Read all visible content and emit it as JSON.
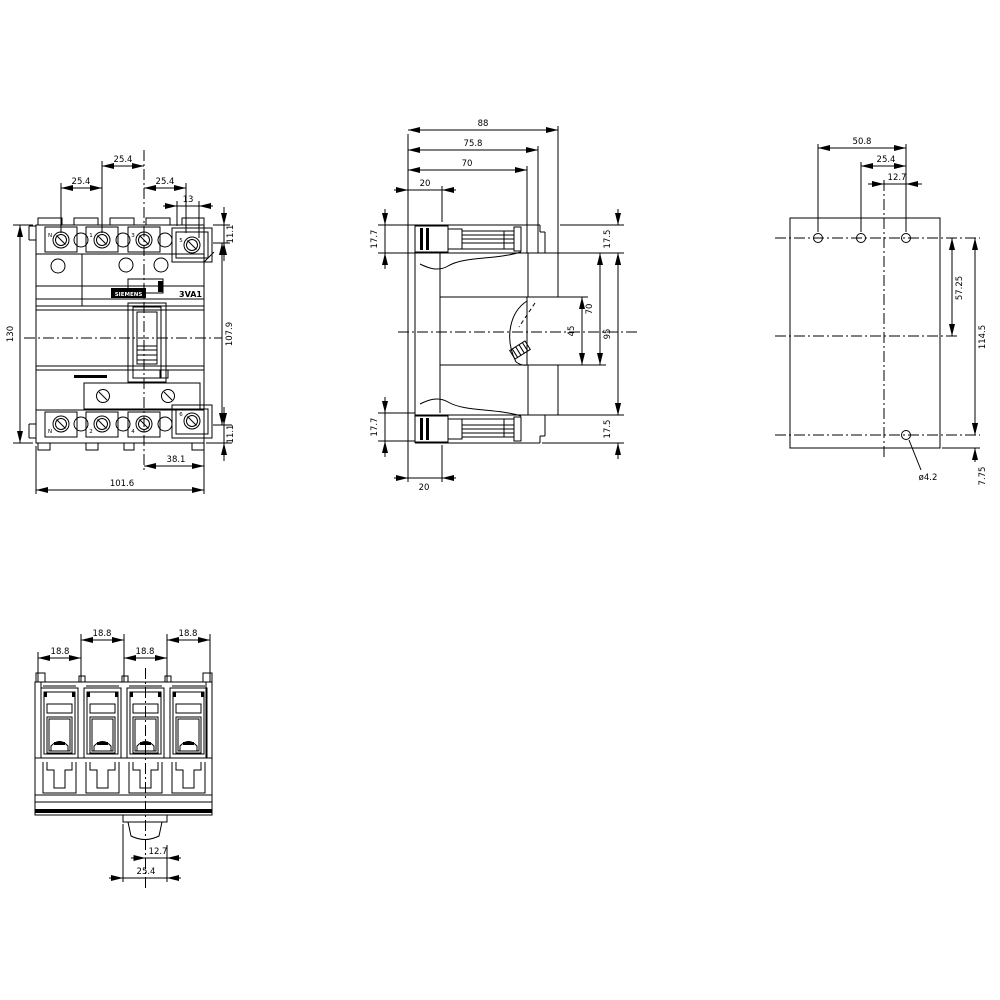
{
  "front": {
    "brand": "SIEMENS",
    "product": "3VA1",
    "poles_top": [
      "N",
      "1",
      "3",
      "5"
    ],
    "poles_bottom": [
      "N",
      "2",
      "4",
      "6"
    ],
    "dims": {
      "pitch_mid": "25.4",
      "pitch_left": "25.4",
      "pitch_right": "25.4",
      "neutral_offset": "13",
      "terminal_top": "11.1",
      "overall_height": "130",
      "case_height": "107.9",
      "terminal_bottom": "11.1",
      "handle_to_edge": "38.1",
      "overall_width": "101.6"
    }
  },
  "side": {
    "dims": {
      "depth": "88",
      "front_face": "75.8",
      "step": "70",
      "lug_top": "20",
      "lug_height_top": "17.7",
      "cover_top": "17.5",
      "window": "45",
      "front_height": "70",
      "case_height": "95",
      "lug_height_bottom": "17.7",
      "cover_bottom": "17.5",
      "lug_bottom": "20"
    }
  },
  "rear": {
    "dims": {
      "hole_span": "50.8",
      "hole_mid": "25.4",
      "hole_to_center": "12.7",
      "upper_height": "57.25",
      "overall_height": "114.5",
      "bottom_offset": "7.75",
      "hole_diameter": "ø4.2"
    }
  },
  "bottom": {
    "dims": {
      "pitch_a": "18.8",
      "pitch_b": "18.8",
      "pitch_c": "18.8",
      "pitch_d": "18.8",
      "din_center": "12.7",
      "din_width": "25.4"
    }
  }
}
